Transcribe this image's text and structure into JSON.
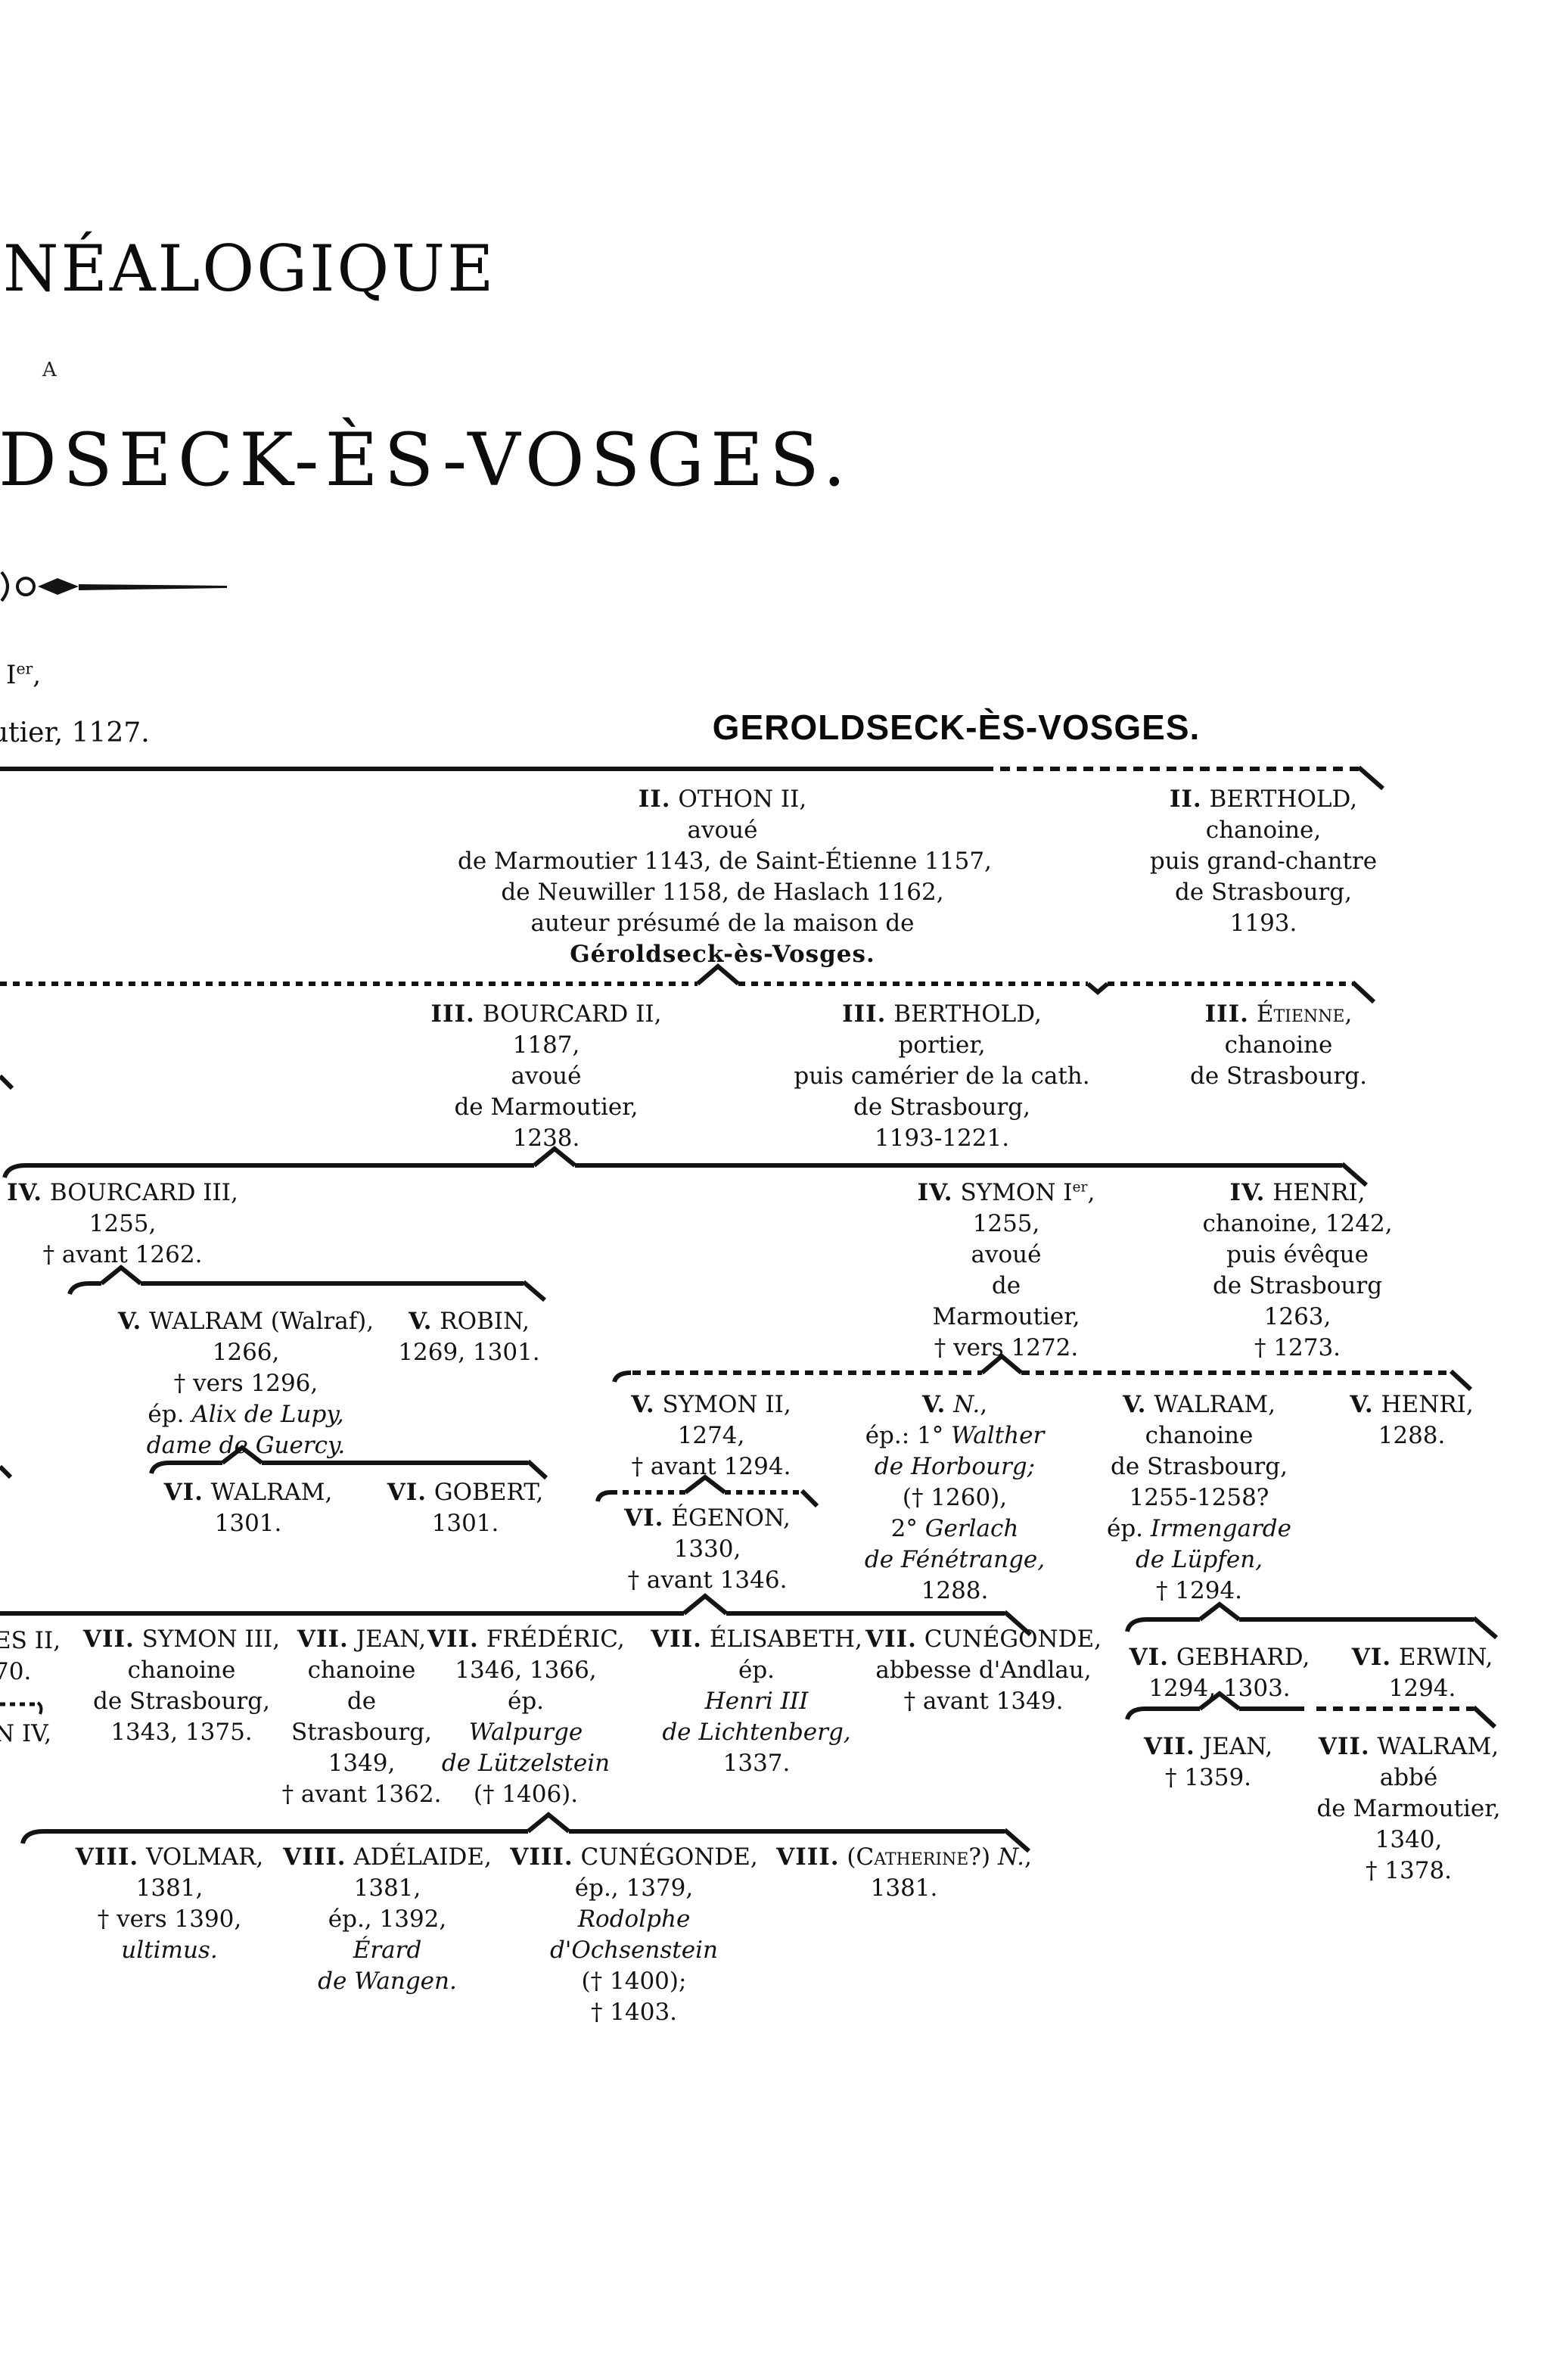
{
  "page": {
    "title_fragment_top": "NÉALOGIQUE",
    "title_fragment_a": "A",
    "title_fragment_main": "DSECK-ÈS-VOSGES.",
    "margin_fragment_ier": "I<sup>er</sup>,",
    "margin_fragment_utier": "utier, 1127.",
    "margin_fragment_es_ii": "ES II,",
    "margin_fragment_70": "70.",
    "margin_fragment_n_iv": "N IV,",
    "section_heading": "GEROLDSECK-ÈS-VOSGES."
  },
  "persons": {
    "othon2": {
      "lines": [
        "<b>II.</b> OTHON II,",
        "avoué",
        "de Marmoutier 1143, de Saint-Étienne 1157,",
        "de Neuwiller 1158, de Haslach 1162,",
        "auteur présumé de la maison de",
        "<b>Géroldseck-ès-Vosges.</b>"
      ]
    },
    "berthold2": {
      "lines": [
        "<b>II.</b> BERTHOLD,",
        "chanoine,",
        "puis grand-chantre",
        "de Strasbourg,",
        "1193."
      ]
    },
    "bourcard2": {
      "lines": [
        "<b>III.</b> BOURCARD II,",
        "1187,",
        "avoué",
        "de Marmoutier,",
        "1238."
      ]
    },
    "berthold3": {
      "lines": [
        "<b>III.</b> BERTHOLD,",
        "portier,",
        "puis camérier de la cath.",
        "de Strasbourg,",
        "1193-1221."
      ]
    },
    "etienne3": {
      "lines": [
        "<b>III.</b> <span class='sc'>Étienne</span>,",
        "chanoine",
        "de Strasbourg."
      ]
    },
    "bourcard3": {
      "lines": [
        "<b>IV.</b> BOURCARD III,",
        "1255,",
        "† avant 1262."
      ]
    },
    "symon1": {
      "lines": [
        "<b>IV.</b> SYMON I<sup>er</sup>,",
        "1255,",
        "avoué",
        "de",
        "Marmoutier,",
        "† vers 1272."
      ]
    },
    "henri4": {
      "lines": [
        "<b>IV.</b> HENRI,",
        "chanoine, 1242,",
        "puis évêque",
        "de Strasbourg",
        "1263,",
        "† 1273."
      ]
    },
    "walram5": {
      "lines": [
        "<b>V.</b> WALRAM (Walraf),",
        "1266,",
        "† vers 1296,",
        "ép. <i>Alix de Lupy,</i>",
        "<i>dame de Guercy.</i>"
      ]
    },
    "robin5": {
      "lines": [
        "<b>V.</b> ROBIN,",
        "1269, 1301."
      ]
    },
    "symon2": {
      "lines": [
        "<b>V.</b> SYMON II,",
        "1274,",
        "† avant 1294."
      ]
    },
    "n5": {
      "lines": [
        "<b>V.</b> <i>N.</i>,",
        "ép.: 1° <i>Walther</i>",
        "<i>de Horbourg;</i>",
        "(† 1260),",
        "2° <i>Gerlach</i>",
        "<i>de Fénétrange,</i>",
        "1288."
      ]
    },
    "walram5r": {
      "lines": [
        "<b>V.</b> WALRAM,",
        "chanoine",
        "de Strasbourg,",
        "1255-1258?",
        "ép. <i>Irmengarde</i>",
        "<i>de Lüpfen,</i>",
        "† 1294."
      ]
    },
    "henri5": {
      "lines": [
        "<b>V.</b> HENRI,",
        "1288."
      ]
    },
    "walram6": {
      "lines": [
        "<b>VI.</b> WALRAM,",
        "1301."
      ]
    },
    "gobert6": {
      "lines": [
        "<b>VI.</b> GOBERT,",
        "1301."
      ]
    },
    "egenon6": {
      "lines": [
        "<b>VI.</b> ÉGENON,",
        "1330,",
        "† avant 1346."
      ]
    },
    "gebhard6": {
      "lines": [
        "<b>VI.</b> GEBHARD,",
        "1294, 1303."
      ]
    },
    "erwin6": {
      "lines": [
        "<b>VI.</b> ERWIN,",
        "1294."
      ]
    },
    "symon3": {
      "lines": [
        "<b>VII.</b> SYMON III,",
        "chanoine",
        "de Strasbourg,",
        "1343, 1375."
      ]
    },
    "jean7": {
      "lines": [
        "<b>VII.</b> JEAN,",
        "chanoine",
        "de",
        "Strasbourg,",
        "1349,",
        "† avant 1362."
      ]
    },
    "frederic7": {
      "lines": [
        "<b>VII.</b> FRÉDÉRIC,",
        "1346, 1366,",
        "ép.",
        "<i>Walpurge</i>",
        "<i>de Lützelstein</i>",
        "(† 1406)."
      ]
    },
    "elisabeth7": {
      "lines": [
        "<b>VII.</b> ÉLISABETH,",
        "ép.",
        "<i>Henri III</i>",
        "<i>de Lichtenberg,</i>",
        "1337."
      ]
    },
    "cunegonde7": {
      "lines": [
        "<b>VII.</b> CUNÉGONDE,",
        "abbesse d'Andlau,",
        "† avant 1349."
      ]
    },
    "jean7r": {
      "lines": [
        "<b>VII.</b> JEAN,",
        "† 1359."
      ]
    },
    "walram7r": {
      "lines": [
        "<b>VII.</b> WALRAM,",
        "abbé",
        "de Marmoutier,",
        "1340,",
        "† 1378."
      ]
    },
    "volmar8": {
      "lines": [
        "<b>VIII.</b> VOLMAR,",
        "1381,",
        "† vers 1390,",
        "<i>ultimus.</i>"
      ]
    },
    "adelaide8": {
      "lines": [
        "<b>VIII.</b> ADÉLAIDE,",
        "1381,",
        "ép., 1392,",
        "<i>Érard</i>",
        "<i>de Wangen.</i>"
      ]
    },
    "cunegonde8": {
      "lines": [
        "<b>VIII.</b> CUNÉGONDE,",
        "ép., 1379,",
        "<i>Rodolphe</i>",
        "<i>d'Ochsenstein</i>",
        "(† 1400);",
        "† 1403."
      ]
    },
    "catherine8": {
      "lines": [
        "<b>VIII.</b> (<span class='sc'>Catherine</span>?) <i>N.</i>,",
        "1381."
      ]
    }
  }
}
